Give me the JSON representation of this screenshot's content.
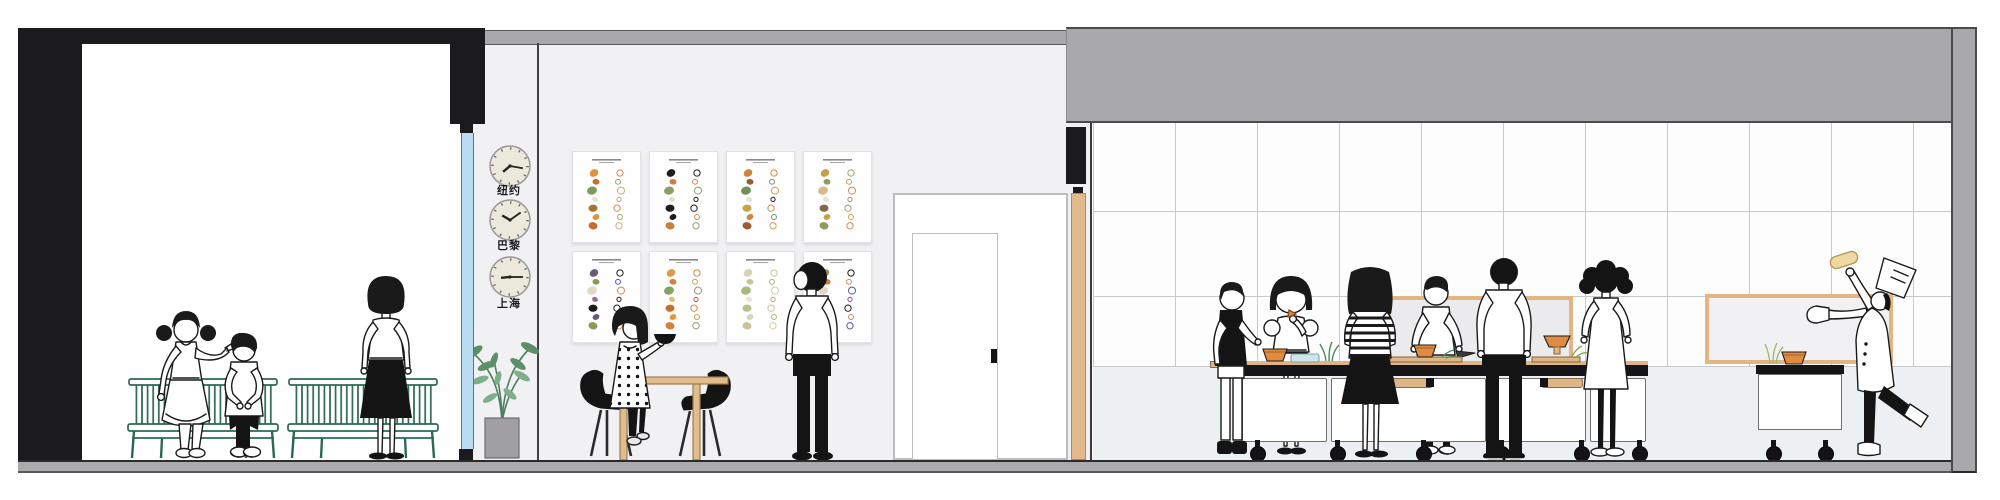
{
  "scene": {
    "label": "Restaurant interior section illustration",
    "width": 2000,
    "height": 500
  },
  "palette": {
    "wall_black": "#1b1b1d",
    "band_gray": "#a9a9ab",
    "floor_gray": "#ababad",
    "wall_light": "#f1f1f3",
    "tile_white": "#fdfdfe",
    "tile_line": "#c9c9cb",
    "below_tile": "#edf0f3",
    "bench_green": "#2a6a50",
    "wood_tan": "#e2bd8c",
    "frame_tan": "#e2b583",
    "glass_blue": "#badcf2",
    "accent_orange": "#e08b41",
    "leaf_green": "#558b66",
    "clock_face": "#ece8db"
  },
  "waiting_area": {
    "benches": 2,
    "people": [
      {
        "id": "seated-woman"
      },
      {
        "id": "seated-boy"
      },
      {
        "id": "standing-woman"
      }
    ]
  },
  "clock_wall": {
    "clocks": [
      {
        "city": "纽约",
        "hour_angle": 230,
        "minute_angle": 100
      },
      {
        "city": "巴黎",
        "hour_angle": 300,
        "minute_angle": 55
      },
      {
        "city": "上海",
        "hour_angle": 265,
        "minute_angle": 90
      }
    ]
  },
  "gallery_wall": {
    "rows": 2,
    "columns": 4,
    "posters": [
      {
        "fill": [
          "#e0913f",
          "#c96f2e",
          "#7d9c5b",
          "#e8e2d4",
          "#a9742f"
        ],
        "outline": [
          "#d98a4a",
          "#9aa86a",
          "#c9b174",
          "#adada0"
        ]
      },
      {
        "fill": [
          "#1d1d1d",
          "#c9803b",
          "#8aa060",
          "#e5ded0",
          "#1d1d1d"
        ],
        "outline": [
          "#1d1d1d",
          "#cf8a50",
          "#8aa06a",
          "#1d1d1d"
        ]
      },
      {
        "fill": [
          "#d2823c",
          "#9c5a32",
          "#728f55",
          "#e8e0d2",
          "#caa24a"
        ],
        "outline": [
          "#d98a4a",
          "#6a9a6a",
          "#caa24a",
          "#1d1d1d"
        ]
      },
      {
        "fill": [
          "#c9a04a",
          "#8f9c5b",
          "#d9b98a",
          "#e8e2d4",
          "#7d6a4a"
        ],
        "outline": [
          "#9aa86a",
          "#caa24a",
          "#d98a4a",
          "#8aa06a"
        ]
      },
      {
        "fill": [
          "#6a5a7a",
          "#8a9a5a",
          "#e0d8c8",
          "#9a6a8a",
          "#1d1d1d"
        ],
        "outline": [
          "#1d1d1d",
          "#4a5aaa",
          "#d98a4a",
          "#1d1d1d"
        ]
      },
      {
        "fill": [
          "#e09a45",
          "#d2823c",
          "#8aa060",
          "#e8ba6a",
          "#c96f2e"
        ],
        "outline": [
          "#d98a4a",
          "#caa24a",
          "#8aa06a",
          "#cf5a3a"
        ]
      },
      {
        "fill": [
          "#d8d2b8",
          "#c9c29a",
          "#a8b878",
          "#e8e2cc",
          "#b8c288"
        ],
        "outline": [
          "#c9c29a",
          "#a8b878",
          "#d8cc9a",
          "#b8ab7a"
        ]
      },
      {
        "fill": [
          "#8a9a5a",
          "#c9803b",
          "#e0d8c8",
          "#9c5a32",
          "#7d9c5b"
        ],
        "outline": [
          "#1d1d1d",
          "#cf8a50",
          "#4a5aaa",
          "#9a4a8a"
        ]
      }
    ]
  },
  "dining_area": {
    "furniture": [
      "wood-table",
      "black-chair",
      "black-chair"
    ],
    "people": [
      {
        "id": "seated-girl-with-bowl"
      },
      {
        "id": "standing-man"
      }
    ]
  },
  "door": {
    "leaves": 1,
    "handle_color": "#141416"
  },
  "kitchen": {
    "counter_modules": 4,
    "carts": 1,
    "wall_panels": 2,
    "people": [
      {
        "id": "kid-black-vest"
      },
      {
        "id": "woman-eating"
      },
      {
        "id": "woman-striped-back"
      },
      {
        "id": "boy-cutting"
      },
      {
        "id": "man-back-white-shirt"
      },
      {
        "id": "woman-curly-dress"
      },
      {
        "id": "chef-tossing"
      }
    ],
    "counter_items": [
      "orange-bowl",
      "glass-dish",
      "spring-onions",
      "cutting-board",
      "orange-bowl",
      "pedestal-bowl",
      "greens",
      "cart-bowl",
      "tossed-dough"
    ]
  }
}
